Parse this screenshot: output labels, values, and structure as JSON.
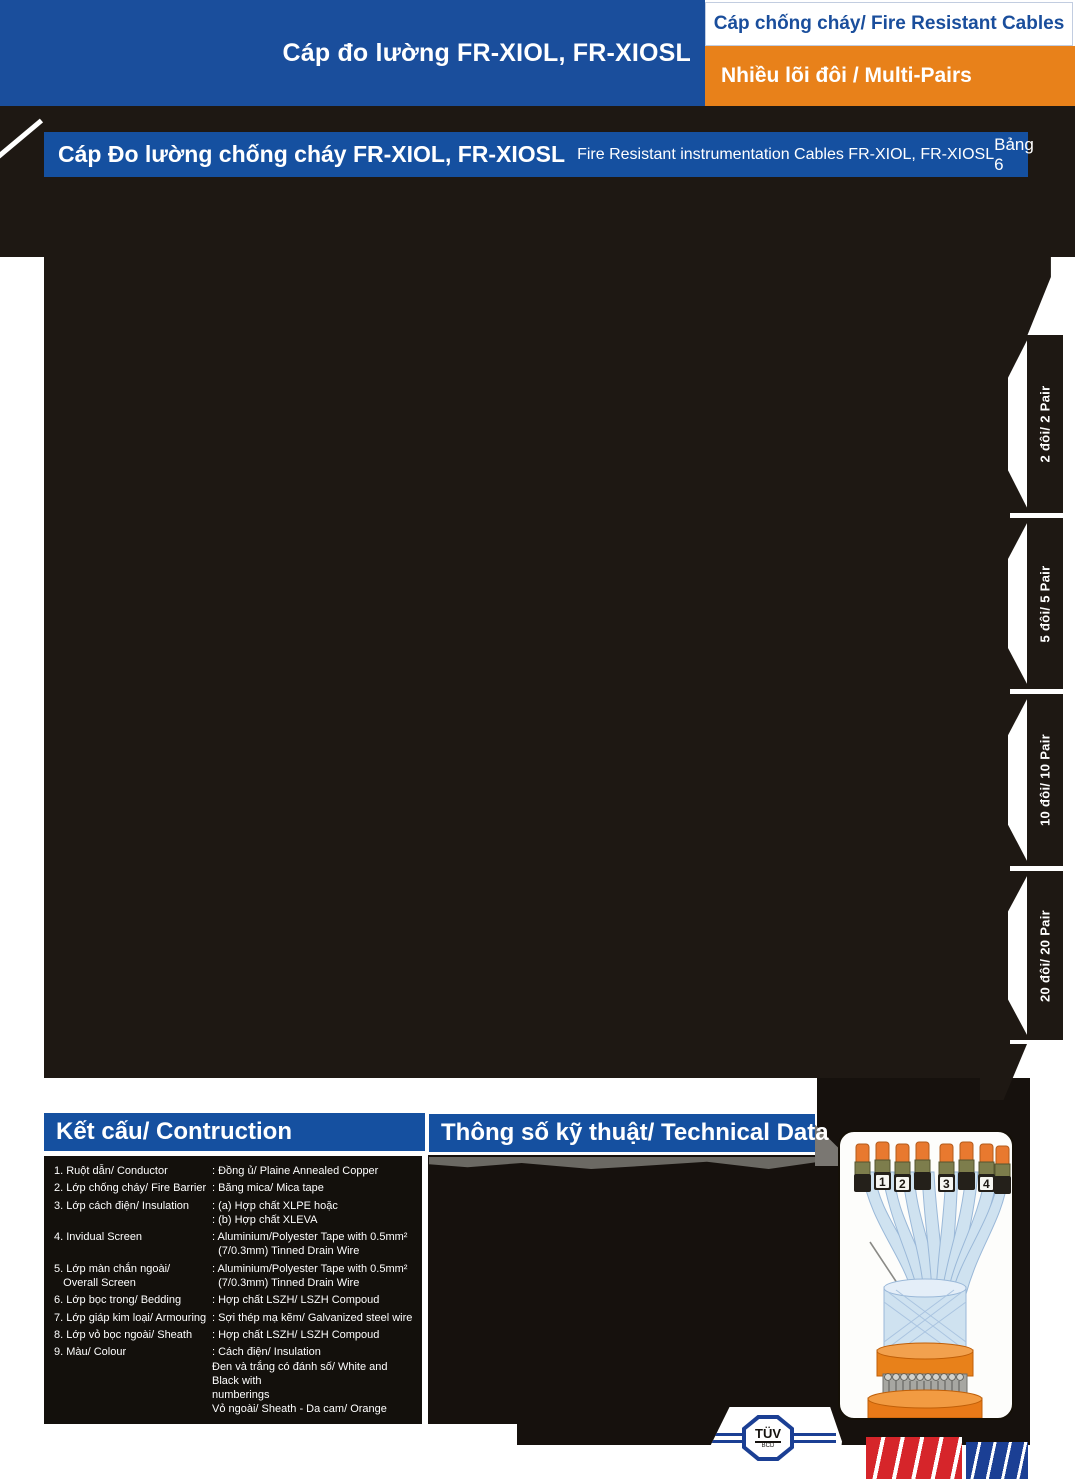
{
  "header": {
    "top_title": "Cáp đo lường FR-XIOL, FR-XIOSL",
    "category_tab": "Cáp chống cháy/ Fire Resistant Cables",
    "subcategory_tab": "Nhiều lõi đôi / Multi-Pairs",
    "section_title_vi": "Cáp Đo lường chống cháy FR-XIOL, FR-XIOSL",
    "section_title_en": "Fire Resistant instrumentation Cables FR-XIOL, FR-XIOSL",
    "table_ref": "Bảng 6"
  },
  "side_tabs": [
    {
      "label": "2 đôi/ 2 Pair"
    },
    {
      "label": "5 đôi/ 5 Pair"
    },
    {
      "label": "10 đôi/ 10 Pair"
    },
    {
      "label": "20 đôi/ 20 Pair"
    }
  ],
  "construction": {
    "header": "Kết cấu/ Contruction",
    "rows": [
      {
        "label": "1. Ruột dẫn/ Conductor",
        "value": ": Đồng ủ/ Plaine Annealed Copper"
      },
      {
        "label": "2. Lớp chống cháy/ Fire Barrier",
        "value": ": Băng mica/ Mica tape"
      },
      {
        "label": "3. Lớp cách điện/ Insulation",
        "value": ": (a) Hợp chất XLPE hoặc\n: (b) Hợp chất XLEVA"
      },
      {
        "label": "4. Invidual Screen",
        "value": ": Aluminium/Polyester Tape with 0.5mm²\n  (7/0.3mm) Tinned Drain Wire"
      },
      {
        "label": "5. Lớp màn chắn ngoài/\n   Overall Screen",
        "value": ": Aluminium/Polyester Tape with 0.5mm²\n  (7/0.3mm) Tinned Drain Wire"
      },
      {
        "label": "6. Lớp bọc  trong/ Bedding",
        "value": ": Hợp chất LSZH/ LSZH Compoud"
      },
      {
        "label": "7. Lớp giáp kim loại/ Armouring",
        "value": ": Sợi thép mạ kẽm/ Galvanized steel wire"
      },
      {
        "label": "8. Lớp vỏ bọc ngoài/ Sheath",
        "value": ": Hợp chất LSZH/ LSZH Compoud"
      },
      {
        "label": "9. Màu/ Colour",
        "value": ": Cách điện/ Insulation\nĐen và trắng có đánh số/ White and Black with\nnumberings\nVỏ ngoài/ Sheath - Da cam/ Orange"
      }
    ]
  },
  "technical": {
    "header": "Thông số kỹ thuật/ Technical Data"
  },
  "cable_image": {
    "numbers": [
      "1",
      "2",
      "3",
      "4"
    ]
  },
  "certification": {
    "tuv_label": "TÜV",
    "tuv_sub": "BCD"
  },
  "colors": {
    "blue": "#1a4e9c",
    "bar_blue": "#1550a0",
    "orange": "#e8811a",
    "black": "#1e1813",
    "logo_red": "#d6252a",
    "logo_blue": "#1b3f94"
  }
}
